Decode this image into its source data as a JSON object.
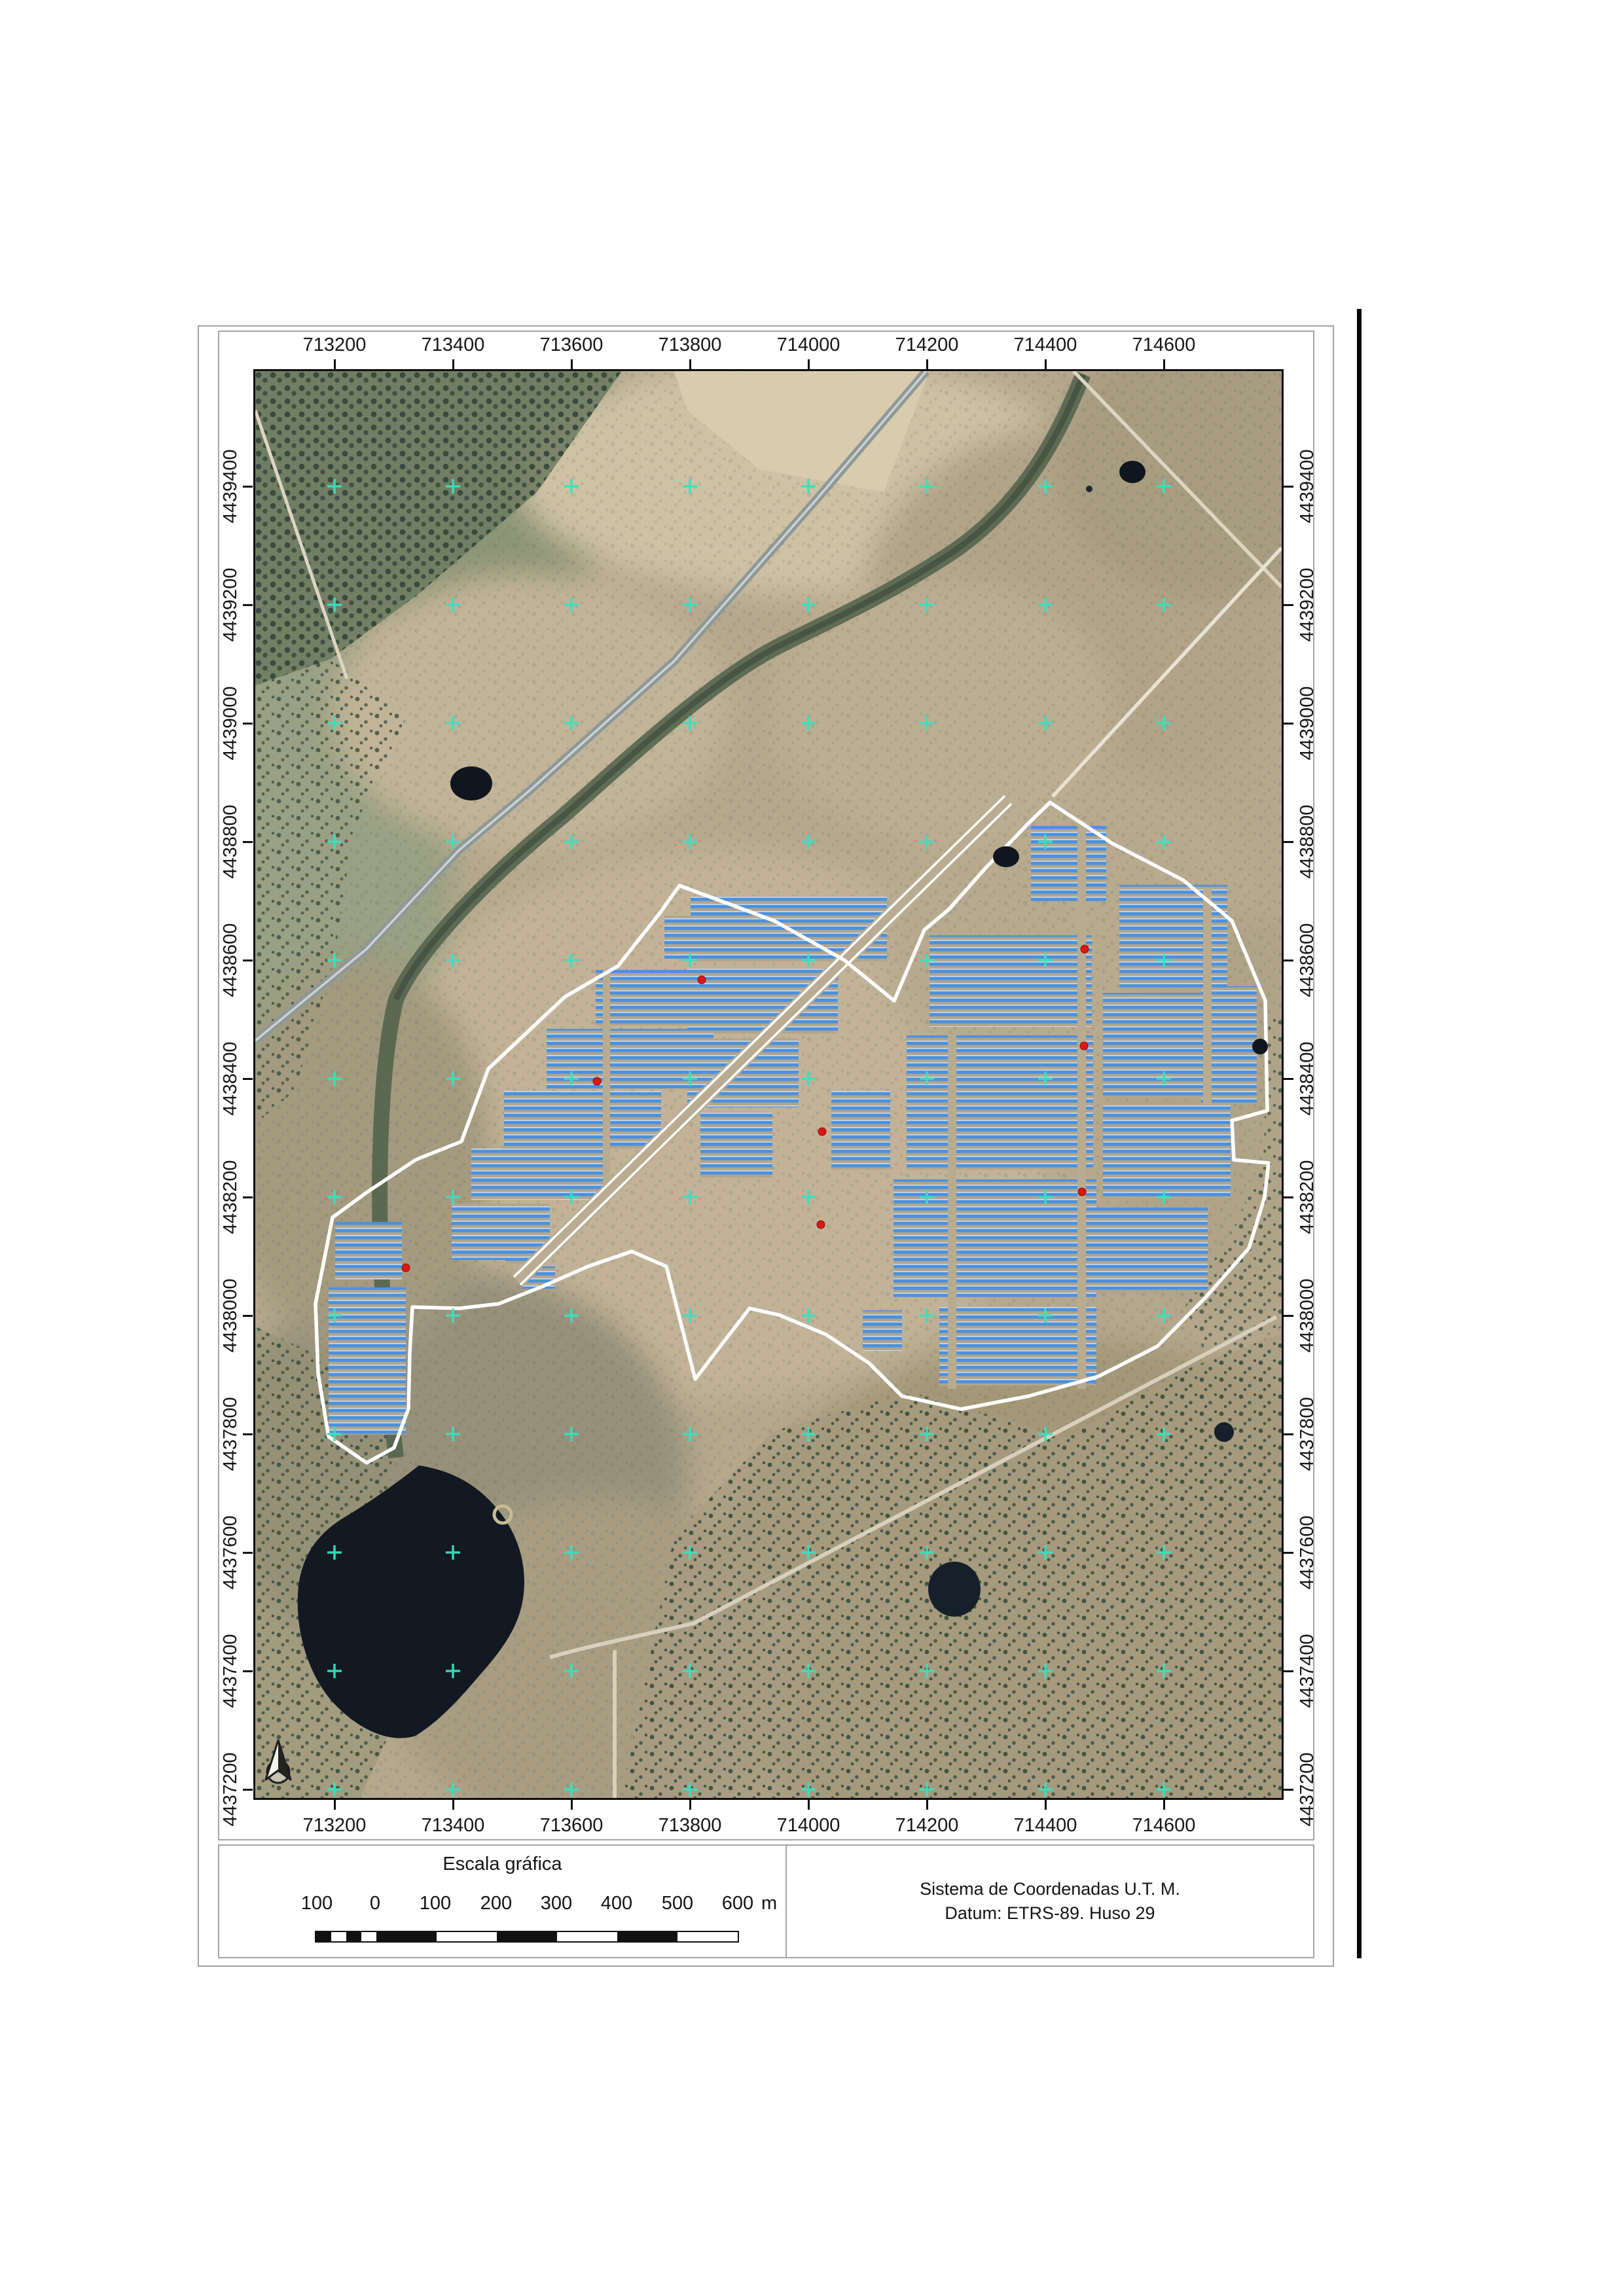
{
  "document": {
    "kind": "printed map sheet",
    "background": "#ffffff"
  },
  "map": {
    "x_labels": [
      "713200",
      "713400",
      "713600",
      "713800",
      "714000",
      "714200",
      "714400",
      "714600"
    ],
    "y_labels": [
      "4439400",
      "4439200",
      "4439000",
      "4438800",
      "4438600",
      "4438400",
      "4438200",
      "4438000",
      "4437800",
      "4437600",
      "4437400",
      "4437200"
    ],
    "grid_interval_m": 200,
    "red_markers": [
      [
        230,
        1370
      ],
      [
        522,
        1085
      ],
      [
        682,
        930
      ],
      [
        1267,
        883
      ],
      [
        1266,
        1031
      ],
      [
        1263,
        1254
      ],
      [
        866,
        1162
      ],
      [
        864,
        1304
      ]
    ],
    "north_arrow_icon": "north-arrow-icon"
  },
  "scale_bar": {
    "title": "Escala gráfica",
    "tick_labels": [
      "100",
      "0",
      "100",
      "200",
      "300",
      "400",
      "500",
      "600"
    ],
    "unit": "m"
  },
  "crs_panel": {
    "line1": "Sistema de Coordenadas U.T. M.",
    "line2": "Datum: ETRS-89. Huso 29"
  },
  "colors": {
    "solar_panel_blue": "#4a91de",
    "site_boundary_white": "#ffffff",
    "marker_red": "#e01515",
    "grid_cross_cyan": "#3bdfbe",
    "water_dark": "#131922",
    "terrain_tan": "#b5a88e"
  }
}
